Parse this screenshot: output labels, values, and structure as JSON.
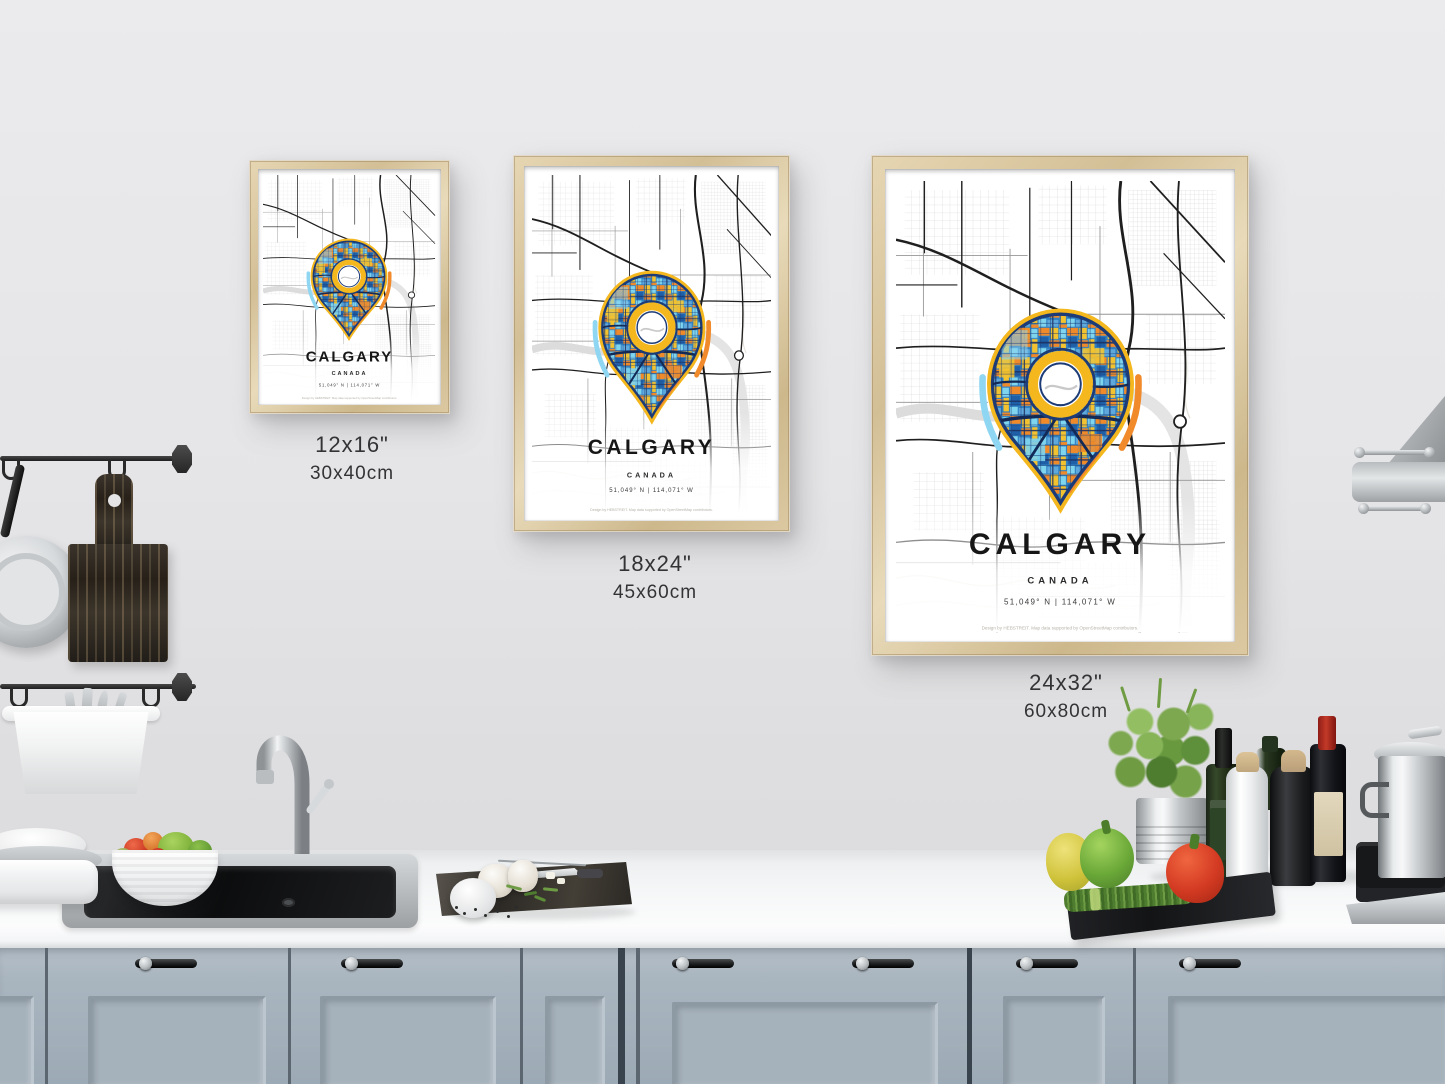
{
  "posters": {
    "small": {
      "city": "CALGARY",
      "country": "CANADA",
      "coordinates": "51,049° N | 114,071° W",
      "credit": "Design by HEBSTREIT. Map data supported by OpenStreetMap contributors.",
      "size_inches": "12x16\"",
      "size_cm": "30x40cm"
    },
    "medium": {
      "city": "CALGARY",
      "country": "CANADA",
      "coordinates": "51,049° N | 114,071° W",
      "credit": "Design by HEBSTREIT. Map data supported by OpenStreetMap contributors.",
      "size_inches": "18x24\"",
      "size_cm": "45x60cm"
    },
    "large": {
      "city": "CALGARY",
      "country": "CANADA",
      "coordinates": "51,049° N | 114,071° W",
      "credit": "Design by HEBSTREIT. Map data supported by OpenStreetMap contributors.",
      "size_inches": "24x32\"",
      "size_cm": "60x80cm"
    }
  },
  "colors": {
    "wall": "#e6e6e8",
    "frame_wood": "#d9c7a2",
    "cabinet": "#a9b5bf",
    "countertop": "#f6f7f8",
    "map_road": "#1f1f1f",
    "pin_yellow": "#f4b71d",
    "pin_orange": "#f08a2b",
    "pin_blue": "#2f7fc1",
    "pin_light_blue": "#8fd6f2",
    "pin_navy": "#1d3c77"
  }
}
